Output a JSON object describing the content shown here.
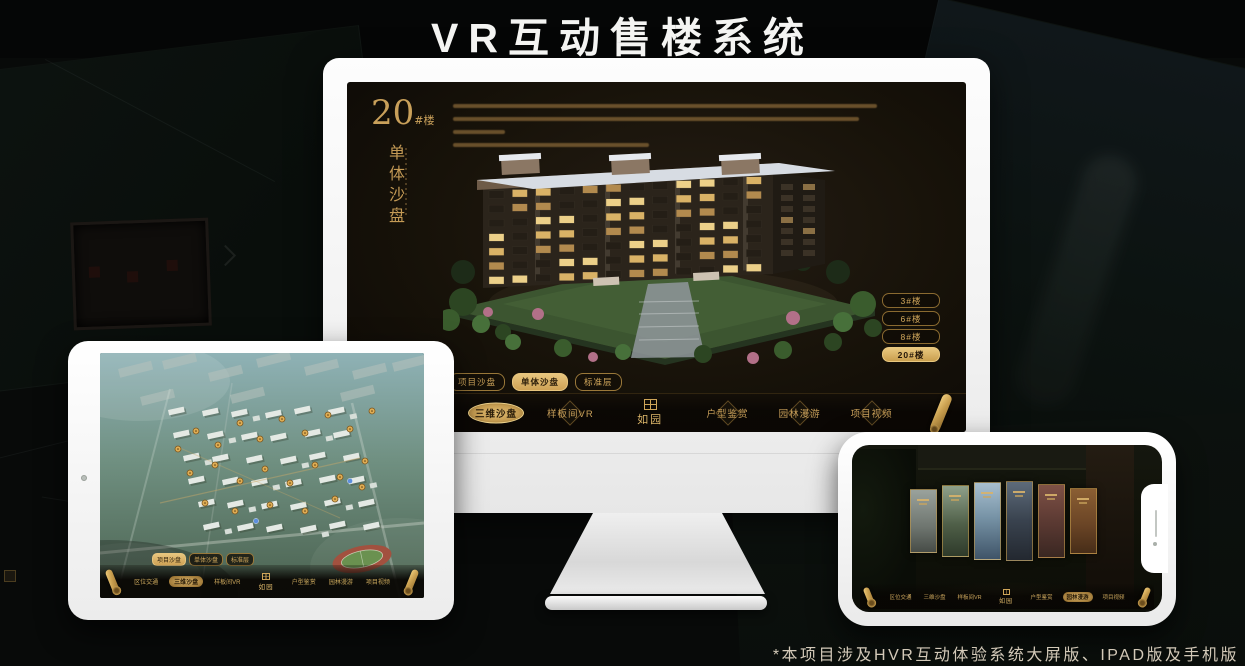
{
  "page": {
    "title": "VR互动售楼系统",
    "footnote": "*本项目涉及HVR互动体验系统大屏版、IPAD版及手机版"
  },
  "colors": {
    "accent_gold": "#c9a05a",
    "accent_gold_deep": "#8a6a2a",
    "screen_bg": "#171209"
  },
  "icons": {
    "scroll": "rolled-scroll",
    "seal": "ruyuan-seal",
    "camera": "front-camera-dot",
    "speaker": "earpiece-slit"
  },
  "desktop": {
    "heading": {
      "number": "20",
      "suffix": "#楼",
      "subtitle": "单体沙盘"
    },
    "sub_tabs": [
      {
        "label": "项目沙盘",
        "active": false
      },
      {
        "label": "单体沙盘",
        "active": true
      },
      {
        "label": "标准层",
        "active": false
      }
    ],
    "building_buttons": [
      {
        "label": "3#楼",
        "active": false
      },
      {
        "label": "6#楼",
        "active": false
      },
      {
        "label": "8#楼",
        "active": false
      },
      {
        "label": "20#楼",
        "active": true
      }
    ],
    "nav_left": [
      {
        "label": "区位交通",
        "active": false
      },
      {
        "label": "三维沙盘",
        "active": true
      },
      {
        "label": "样板间VR",
        "active": false
      }
    ],
    "nav_right": [
      {
        "label": "户型鉴赏",
        "active": false
      },
      {
        "label": "园林漫游",
        "active": false
      },
      {
        "label": "项目视频",
        "active": false
      }
    ],
    "logo": "如园"
  },
  "tablet": {
    "sub_tabs": [
      {
        "label": "项目沙盘",
        "active": true
      },
      {
        "label": "单体沙盘",
        "active": false
      },
      {
        "label": "标准层",
        "active": false
      }
    ],
    "nav_left": [
      {
        "label": "区位交通",
        "active": false
      },
      {
        "label": "三维沙盘",
        "active": true
      },
      {
        "label": "样板间VR",
        "active": false
      }
    ],
    "nav_right": [
      {
        "label": "户型鉴赏",
        "active": false
      },
      {
        "label": "园林漫游",
        "active": false
      },
      {
        "label": "项目视频",
        "active": false
      }
    ],
    "logo": "如园"
  },
  "phone": {
    "nav_left": [
      {
        "label": "区位交通",
        "active": false
      },
      {
        "label": "三维沙盘",
        "active": false
      },
      {
        "label": "样板间VR",
        "active": false
      }
    ],
    "nav_right": [
      {
        "label": "户型鉴赏",
        "active": false
      },
      {
        "label": "园林漫游",
        "active": true
      },
      {
        "label": "项目视频",
        "active": false
      }
    ],
    "logo": "如园"
  }
}
